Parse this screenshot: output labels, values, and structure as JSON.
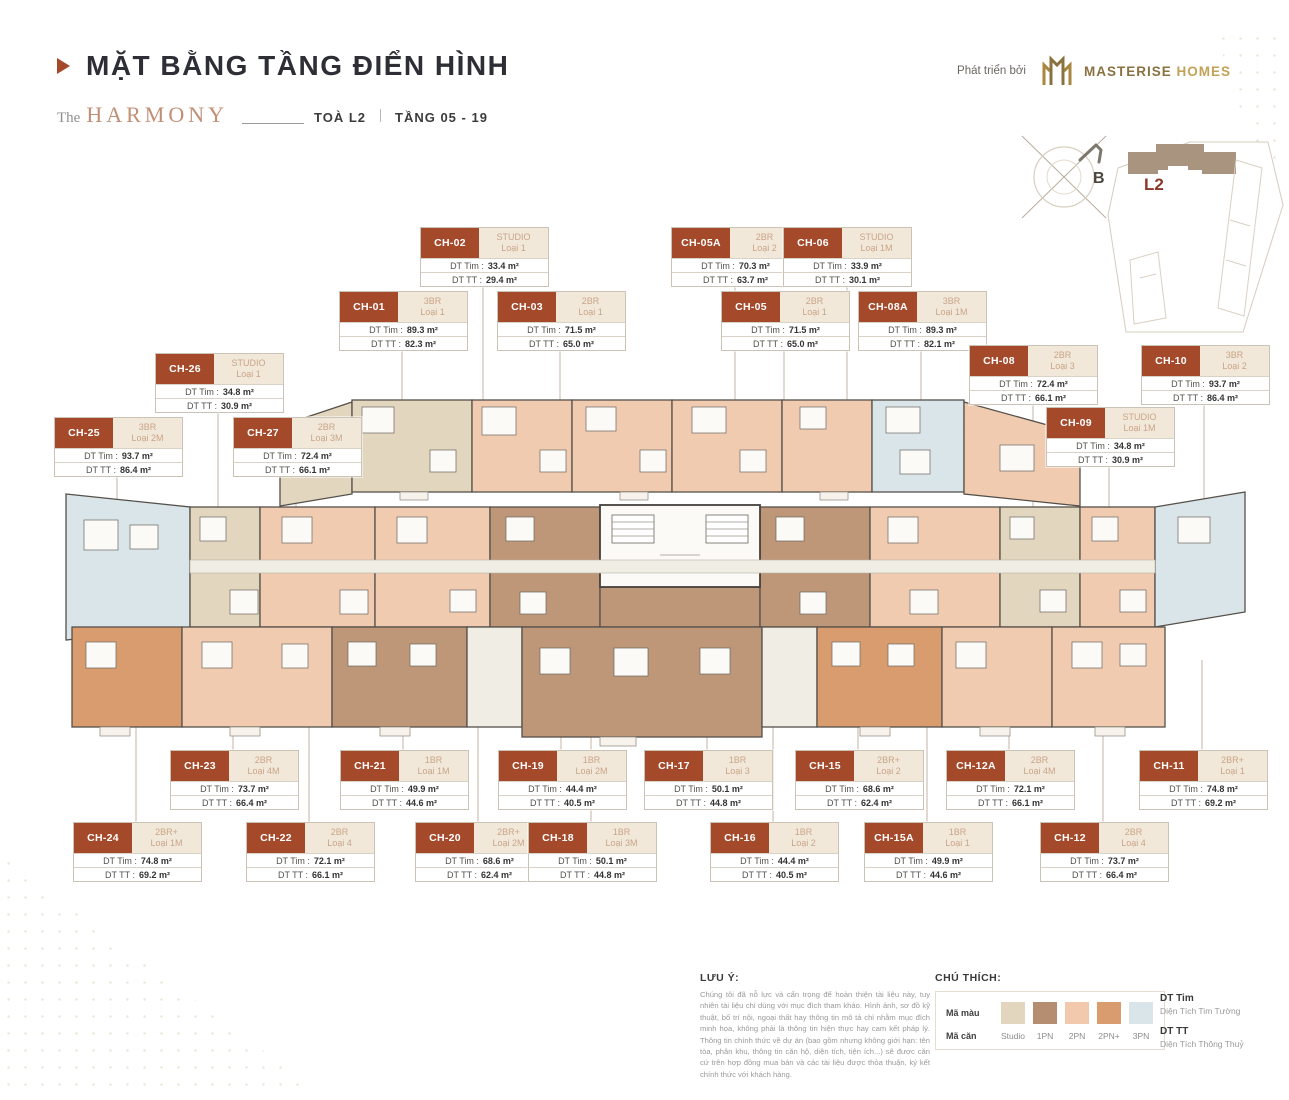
{
  "header": {
    "title": "MẶT BẰNG TẦNG ĐIỂN HÌNH",
    "brand_prefix": "The",
    "brand_name": "HARMONY",
    "tower_label": "TOÀ L2",
    "floor_label": "TẦNG 05 - 19",
    "developer_prefix": "Phát triển bởi",
    "developer_name_1": "MASTERISE",
    "developer_name_2": "HOMES"
  },
  "minimap": {
    "compass_label": "B",
    "tower_label": "L2"
  },
  "unit_labels": {
    "dt_tim": "DT Tim :",
    "dt_tt": "DT TT :"
  },
  "units": [
    {
      "code": "CH-02",
      "type": "STUDIO",
      "variant": "Loại 1",
      "dt_tim": "33.4 m²",
      "dt_tt": "29.4 m²"
    },
    {
      "code": "CH-05A",
      "type": "2BR",
      "variant": "Loại 2",
      "dt_tim": "70.3 m²",
      "dt_tt": "63.7 m²"
    },
    {
      "code": "CH-06",
      "type": "STUDIO",
      "variant": "Loại 1M",
      "dt_tim": "33.9 m²",
      "dt_tt": "30.1 m²"
    },
    {
      "code": "CH-01",
      "type": "3BR",
      "variant": "Loại 1",
      "dt_tim": "89.3 m²",
      "dt_tt": "82.3 m²"
    },
    {
      "code": "CH-03",
      "type": "2BR",
      "variant": "Loại 1",
      "dt_tim": "71.5 m²",
      "dt_tt": "65.0 m²"
    },
    {
      "code": "CH-05",
      "type": "2BR",
      "variant": "Loại 1",
      "dt_tim": "71.5 m²",
      "dt_tt": "65.0 m²"
    },
    {
      "code": "CH-08A",
      "type": "3BR",
      "variant": "Loại 1M",
      "dt_tim": "89.3 m²",
      "dt_tt": "82.1 m²"
    },
    {
      "code": "CH-26",
      "type": "STUDIO",
      "variant": "Loại 1",
      "dt_tim": "34.8 m²",
      "dt_tt": "30.9 m²"
    },
    {
      "code": "CH-08",
      "type": "2BR",
      "variant": "Loại 3",
      "dt_tim": "72.4 m²",
      "dt_tt": "66.1 m²"
    },
    {
      "code": "CH-10",
      "type": "3BR",
      "variant": "Loại 2",
      "dt_tim": "93.7 m²",
      "dt_tt": "86.4 m²"
    },
    {
      "code": "CH-25",
      "type": "3BR",
      "variant": "Loại 2M",
      "dt_tim": "93.7 m²",
      "dt_tt": "86.4 m²"
    },
    {
      "code": "CH-27",
      "type": "2BR",
      "variant": "Loại 3M",
      "dt_tim": "72.4 m²",
      "dt_tt": "66.1 m²"
    },
    {
      "code": "CH-09",
      "type": "STUDIO",
      "variant": "Loại 1M",
      "dt_tim": "34.8 m²",
      "dt_tt": "30.9 m²"
    },
    {
      "code": "CH-23",
      "type": "2BR",
      "variant": "Loại 4M",
      "dt_tim": "73.7 m²",
      "dt_tt": "66.4 m²"
    },
    {
      "code": "CH-21",
      "type": "1BR",
      "variant": "Loại 1M",
      "dt_tim": "49.9 m²",
      "dt_tt": "44.6 m²"
    },
    {
      "code": "CH-19",
      "type": "1BR",
      "variant": "Loại 2M",
      "dt_tim": "44.4 m²",
      "dt_tt": "40.5 m²"
    },
    {
      "code": "CH-17",
      "type": "1BR",
      "variant": "Loại 3",
      "dt_tim": "50.1 m²",
      "dt_tt": "44.8 m²"
    },
    {
      "code": "CH-15",
      "type": "2BR+",
      "variant": "Loại 2",
      "dt_tim": "68.6 m²",
      "dt_tt": "62.4 m²"
    },
    {
      "code": "CH-12A",
      "type": "2BR",
      "variant": "Loại 4M",
      "dt_tim": "72.1 m²",
      "dt_tt": "66.1 m²"
    },
    {
      "code": "CH-11",
      "type": "2BR+",
      "variant": "Loại 1",
      "dt_tim": "74.8 m²",
      "dt_tt": "69.2 m²"
    },
    {
      "code": "CH-24",
      "type": "2BR+",
      "variant": "Loại 1M",
      "dt_tim": "74.8 m²",
      "dt_tt": "69.2 m²"
    },
    {
      "code": "CH-22",
      "type": "2BR",
      "variant": "Loại 4",
      "dt_tim": "72.1 m²",
      "dt_tt": "66.1 m²"
    },
    {
      "code": "CH-20",
      "type": "2BR+",
      "variant": "Loại 2M",
      "dt_tim": "68.6 m²",
      "dt_tt": "62.4 m²"
    },
    {
      "code": "CH-18",
      "type": "1BR",
      "variant": "Loại 3M",
      "dt_tim": "50.1 m²",
      "dt_tt": "44.8 m²"
    },
    {
      "code": "CH-16",
      "type": "1BR",
      "variant": "Loại 2",
      "dt_tim": "44.4 m²",
      "dt_tt": "40.5 m²"
    },
    {
      "code": "CH-15A",
      "type": "1BR",
      "variant": "Loại 1",
      "dt_tim": "49.9 m²",
      "dt_tt": "44.6 m²"
    },
    {
      "code": "CH-12",
      "type": "2BR",
      "variant": "Loại 4",
      "dt_tim": "73.7 m²",
      "dt_tt": "66.4 m²"
    }
  ],
  "notes": {
    "title": "LƯU Ý:",
    "body": "Chúng tôi đã nỗ lực và cẩn trọng để hoàn thiện tài liệu này, tuy nhiên tài liệu chỉ dùng với mục đích tham khảo. Hình ảnh, sơ đồ kỹ thuật, bố trí nội, ngoại thất hay thông tin mô tả chỉ nhằm mục đích minh họa, không phải là thông tin hiện thực hay cam kết pháp lý. Thông tin chính thức về dự án (bao gồm nhưng không giới hạn: tên tòa, phân khu, thông tin căn hộ, diện tích, tiện ích...) sẽ được căn cứ trên hợp đồng mua bán và các tài liệu được thỏa thuận, ký kết chính thức với khách hàng."
  },
  "legend": {
    "title": "CHÚ THÍCH:",
    "row_color_label": "Mã màu",
    "row_unit_label": "Mã căn",
    "items": [
      {
        "label": "Studio",
        "color": "#E3D6BE"
      },
      {
        "label": "1PN",
        "color": "#B58E72"
      },
      {
        "label": "2PN",
        "color": "#F2C9AD"
      },
      {
        "label": "2PN+",
        "color": "#D99C6F"
      },
      {
        "label": "3PN",
        "color": "#D9E5E9"
      }
    ],
    "defs": [
      {
        "abbr": "DT Tim",
        "full": "Diện Tích Tim Tường"
      },
      {
        "abbr": "DT TT",
        "full": "Diện Tích Thông Thuỷ"
      }
    ]
  },
  "colors": {
    "accent_rust": "#A5492B",
    "brand_tan": "#C28E74",
    "gold": "#C3A257"
  }
}
